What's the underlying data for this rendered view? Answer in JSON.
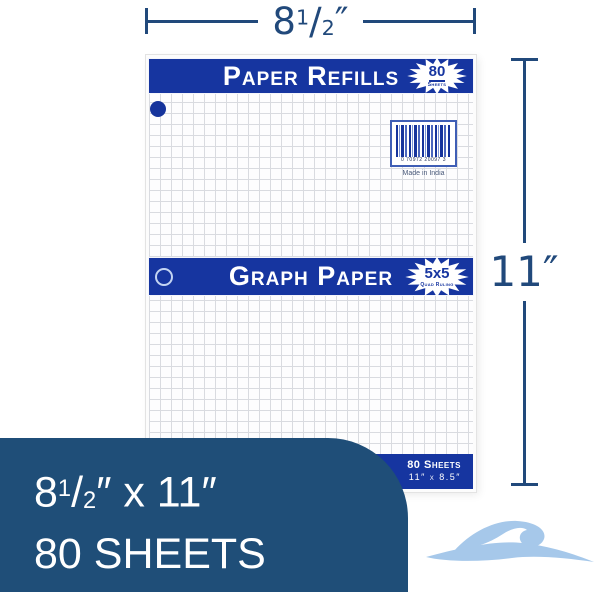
{
  "dimensions": {
    "width": {
      "whole": "8",
      "sup": "1",
      "slash": "/",
      "sub": "2",
      "unit": "″"
    },
    "height_label": "11″"
  },
  "package": {
    "top_banner_label": "Paper Refills",
    "top_badge": {
      "value": "80",
      "caption": "Sheets"
    },
    "barcode": {
      "digits": "0 70972 20097 3",
      "note": "Made in India"
    },
    "middle_banner_label": "Graph Paper",
    "middle_badge": {
      "value": "5x5",
      "caption": "Quad Ruling"
    },
    "bottom_strip": {
      "sheets": "80 Sheets",
      "size": "11″ x 8.5″"
    }
  },
  "info_box": {
    "size_pre": "8",
    "size_sup": "1",
    "size_slash": "/",
    "size_sub": "2",
    "size_post": "″ x 11″",
    "sheets_line": "80 SHEETS"
  },
  "colors": {
    "banner_blue": "#1635a0",
    "info_box_navy": "#1f4e78",
    "dimension_blue": "#21497b",
    "wave_light_blue": "#a6c8ea",
    "grid_line": "#d9dbe0"
  }
}
